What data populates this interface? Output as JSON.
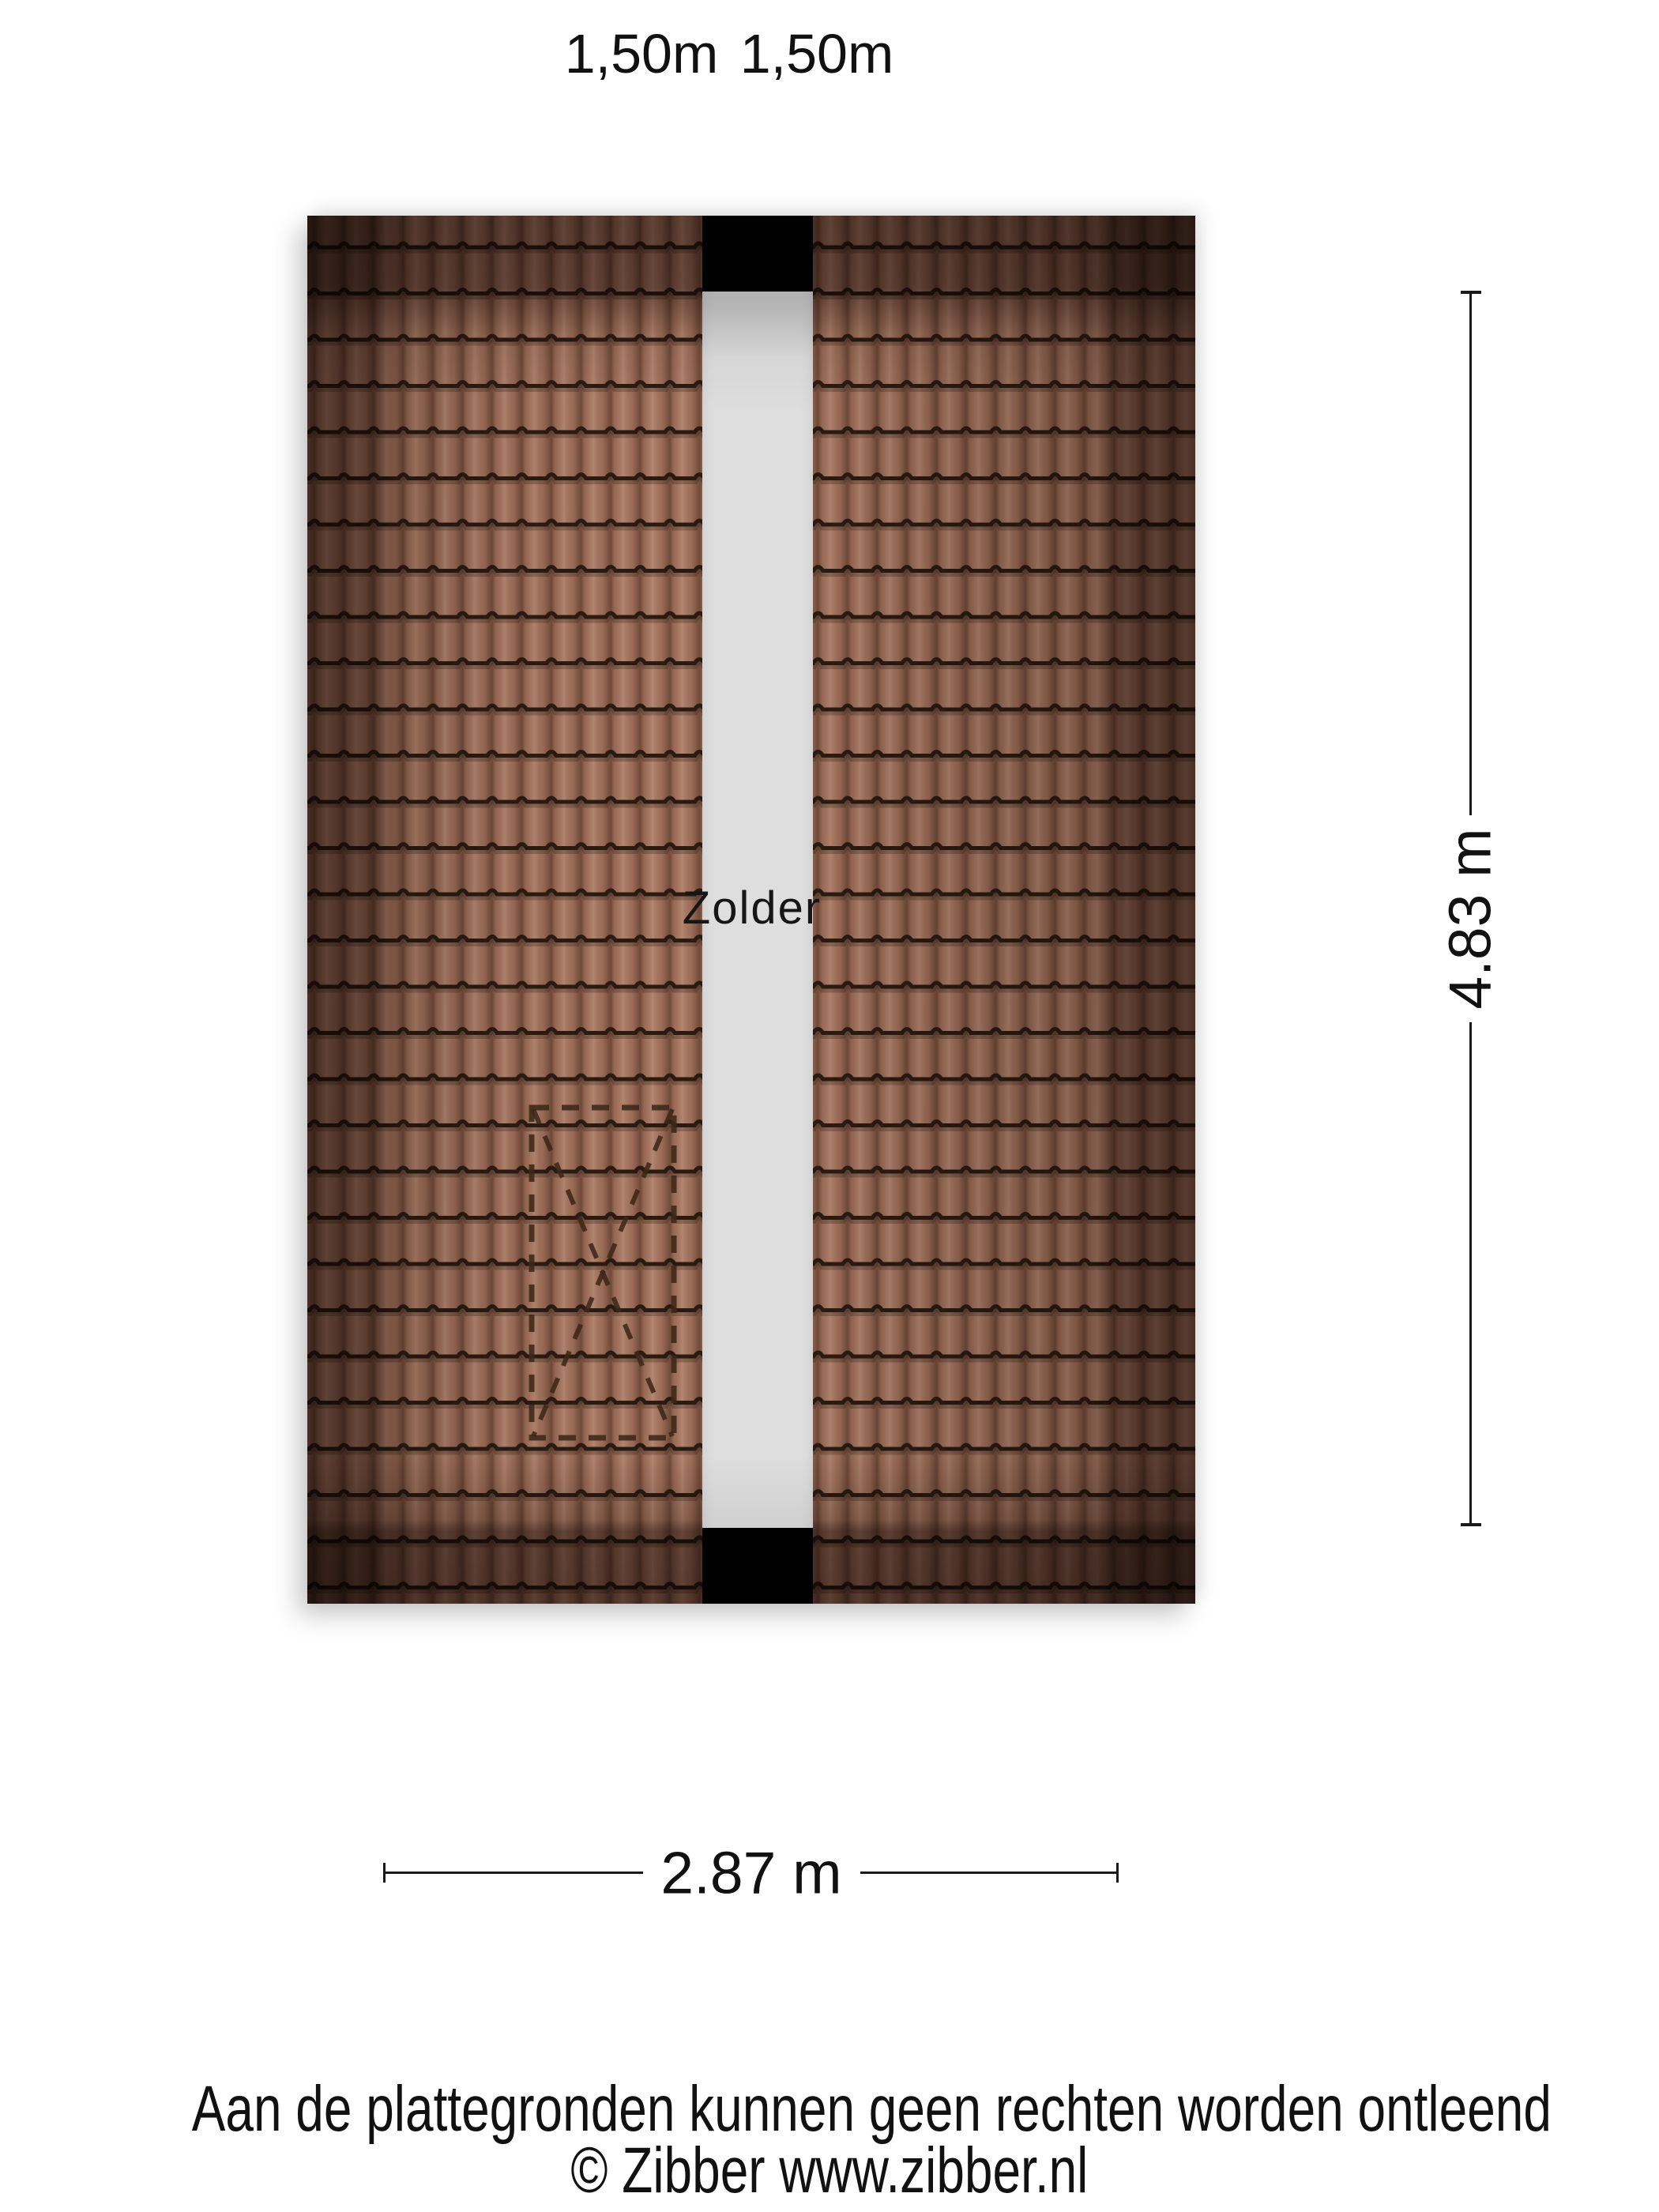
{
  "labels": {
    "top_left_width": "1,50m",
    "top_right_width": "1,50m",
    "room": "Zolder",
    "plan_width": "2.87 m",
    "plan_height": "4.83 m"
  },
  "footer": {
    "disclaimer": "Aan de plattegronden kunnen geen rechten worden ontleend",
    "copyright": "© Zibber www.zibber.nl"
  },
  "colors": {
    "background": "#ffffff",
    "roof_tile": "#a5745e",
    "tile_joint_line": "#2a1b12",
    "roof_edge_shade": "#3a241a",
    "attic_strip": "#dedede",
    "chimney_block": "#000000",
    "stair_dash": "#3c2818",
    "dimension_line": "#1a1a1a",
    "text": "#111111"
  }
}
